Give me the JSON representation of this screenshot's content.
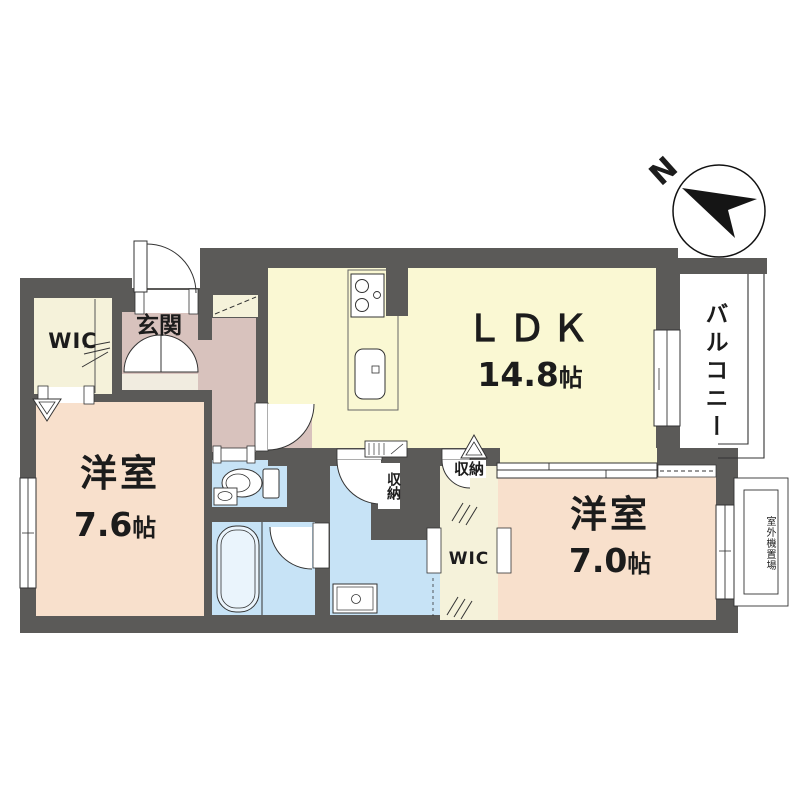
{
  "compass": {
    "north": "N"
  },
  "rooms": {
    "wic_top": {
      "label": "WIC"
    },
    "entrance": {
      "label": "玄関"
    },
    "ldk": {
      "label": "ＬＤＫ",
      "size": "14.8",
      "unit": "帖"
    },
    "balcony": {
      "label": "バルコニー"
    },
    "bedroom_left": {
      "label": "洋室",
      "size": "7.6",
      "unit": "帖"
    },
    "bedroom_right": {
      "label": "洋室",
      "size": "7.0",
      "unit": "帖"
    },
    "wic_center": {
      "label": "WIC"
    },
    "closet_washroom": {
      "label": "収納"
    },
    "closet_ldk": {
      "label": "収納"
    },
    "outdoor_unit_space": {
      "label": "室外機置場"
    }
  },
  "colors": {
    "wall": "#5B5A58",
    "ldk_floor": "#FAF8D3",
    "closet_floor": "#F5F2DA",
    "bedroom_floor": "#F8E0CC",
    "hall_floor": "#D8C2BD",
    "wet_area_floor": "#C7E3F6",
    "line": "#333333"
  }
}
